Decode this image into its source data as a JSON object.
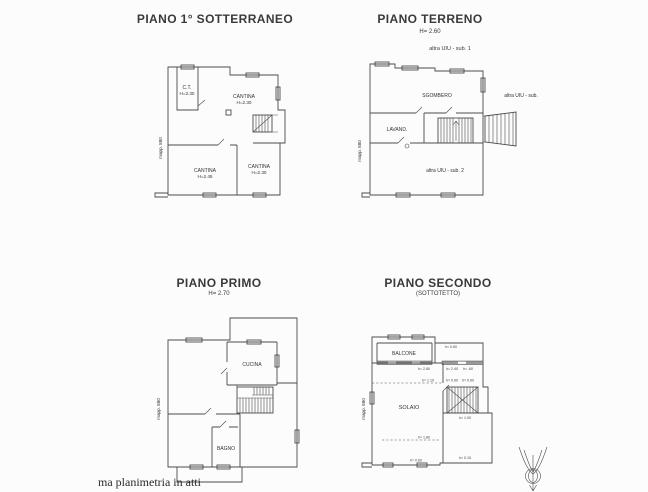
{
  "page": {
    "background": "#fcfcfc",
    "footer_note": "ma planimetria in atti"
  },
  "plans": {
    "sotterraneo": {
      "title": "PIANO 1° SOTTERRANEO",
      "mapp": "mapp. 880",
      "rooms": {
        "ct_name": "C.T.",
        "ct_h": "H=2.30",
        "cantina_top_name": "CANTINA",
        "cantina_top_h": "H=2.30",
        "cantina_left_name": "CANTINA",
        "cantina_left_h": "H=2.45",
        "cantina_right_name": "CANTINA",
        "cantina_right_h": "H=2.30"
      }
    },
    "terreno": {
      "title": "PIANO TERRENO",
      "height_note": "H= 2.60",
      "mapp": "mapp. 880",
      "label_sub1": "altra UIU - sub. 1",
      "label_sub_right": "altra UIU - sub.",
      "label_sub2": "altra UIU - sub. 2",
      "rooms": {
        "sgombero": "SGOMBERO",
        "lavanderia": "LAVAND."
      }
    },
    "primo": {
      "title": "PIANO PRIMO",
      "height_note": "H= 2.70",
      "mapp": "mapp. 880",
      "rooms": {
        "cucina": "CUCINA",
        "bagno": "BAGNO"
      }
    },
    "secondo": {
      "title": "PIANO SECONDO",
      "subtitle": "(SOTTOTETTO)",
      "mapp": "mapp. 880",
      "rooms": {
        "balcone": "BALCONE",
        "solaio": "SOLAIO"
      },
      "annotations": {
        "top_right": "h= 0.60",
        "row1_a": "h= 2.80",
        "row1_b": "h= 2.40",
        "row1_c": "h= .60",
        "row2_a": "h= 1.10",
        "row2_b": "h= 0.60",
        "row2_c": "h= 0.60",
        "stairs": "h= 1.00",
        "mid": "h= 1.80",
        "bottom": "h= 0.60",
        "bottom_right": "h= 0.15"
      }
    }
  }
}
